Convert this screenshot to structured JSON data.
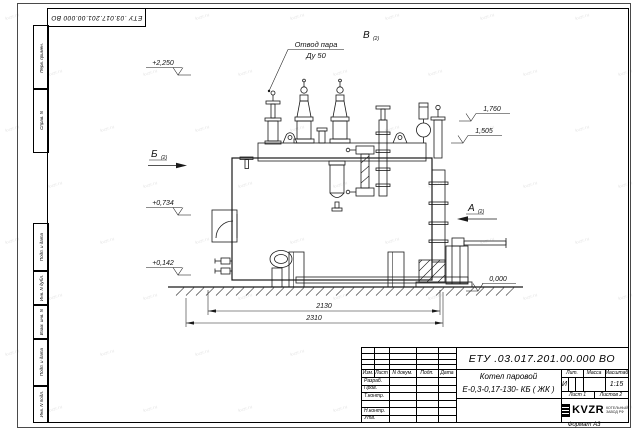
{
  "page": {
    "format_label": "Формат А3"
  },
  "title_block": {
    "doc_number": "ЕТУ .03.017.201.00.000  ВО",
    "product_line1": "Котел паровой",
    "product_line2": "Е-0,3-0,17-130- КБ ( ЖК )",
    "col_headers": [
      "Изм.",
      "Лист",
      "N докум.",
      "Подп.",
      "Дата"
    ],
    "sig_rows": [
      "Разраб.",
      "Пров.",
      "Т.контр.",
      "Н.контр.",
      "Утв."
    ],
    "lit_header": "Лит.",
    "mass_header": "Масса",
    "scale_header": "Масштаб",
    "lit_value": "И",
    "scale_value": "1:15",
    "sheet_info": "Лист 1",
    "sheets_info": "Листов 2",
    "logo_text": "KVZR",
    "logo_sub1": "КОТЕЛЬНЫЙ",
    "logo_sub2": "ЗАВОД РФ"
  },
  "margin_labels": [
    "Перв. примен.",
    "Справ. N",
    "Подп. и дата",
    "Инв. N дубл.",
    "Взам. инв. N",
    "Подп. и дата",
    "Инв. N подл."
  ],
  "annotations": {
    "steam_line1": "Отвод пара",
    "steam_line2": "Ду 50",
    "view_b": "Б",
    "view_a": "А",
    "view_v": "В",
    "view_index": "(2)",
    "elev_top": "+2,250",
    "elev_1760": "1,760",
    "elev_1505": "1,505",
    "elev_0734": "+0,734",
    "elev_0142": "+0,142",
    "elev_zero": "0,000",
    "dim_inner": "2130",
    "dim_outer": "2310"
  },
  "watermark": "kvzr.ru",
  "colors": {
    "line": "#1a1a1a",
    "paper": "#ffffff",
    "watermark": "#777777"
  }
}
